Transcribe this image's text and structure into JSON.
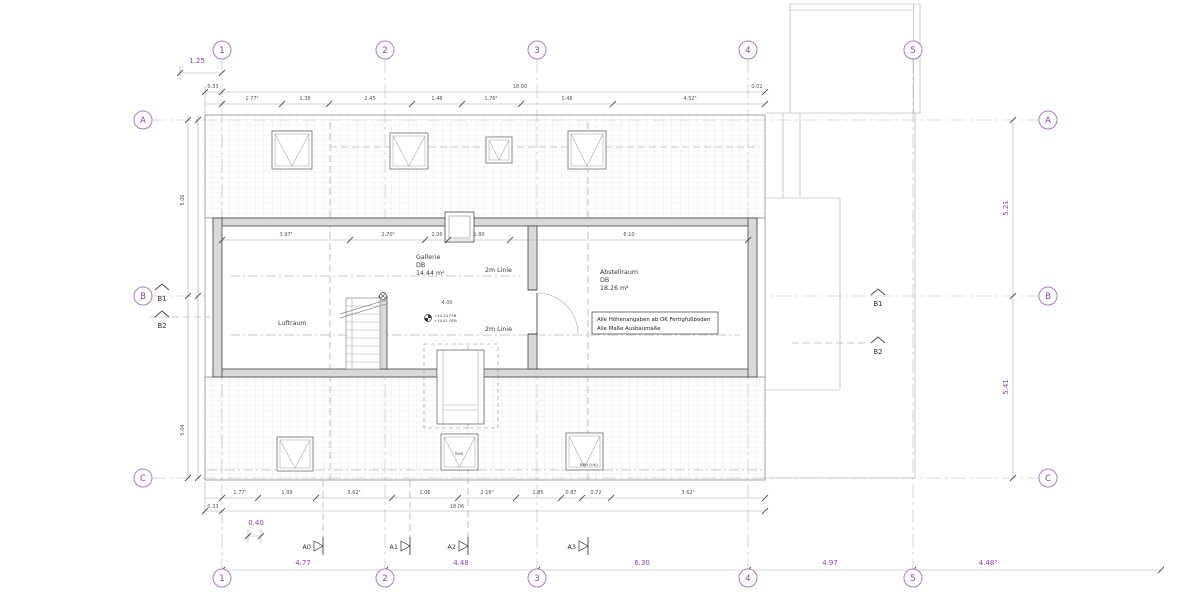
{
  "grid": {
    "top": [
      "1",
      "2",
      "3",
      "4",
      "5"
    ],
    "bottom": [
      "1",
      "2",
      "3",
      "4",
      "5"
    ],
    "left": [
      "A",
      "B",
      "C"
    ],
    "right": [
      "A",
      "B",
      "C"
    ]
  },
  "sections": {
    "left": [
      "B1",
      "B2"
    ],
    "right": [
      "B1",
      "B2"
    ],
    "bottom": [
      "A0",
      "A1",
      "A2",
      "A3"
    ]
  },
  "rooms": {
    "gallerie": {
      "name": "Gallerie",
      "sub": "DB",
      "area": "14.44 m²"
    },
    "abstellraum": {
      "name": "Abstellraum",
      "sub": "DB",
      "area": "18.26 m²"
    },
    "luftraum": {
      "name": "Luftraum"
    },
    "linie2m_upper": {
      "name": "2m Linie"
    },
    "linie2m_lower": {
      "name": "2m Linie"
    }
  },
  "note": {
    "line1": "Alle Höhenangaben ab OK Fertigfußboden",
    "line2": "Alle Maße Ausbaumaße"
  },
  "levels": {
    "ffb": "+10.54 FFB",
    "rfb": "+10.41 RFB"
  },
  "labels": {
    "rwa": "RWA",
    "brh": "BRH 0.90"
  },
  "dims": {
    "purple": {
      "top_left": "1.25",
      "bottom_left": "0.40",
      "bottom": [
        "4.77",
        "4.48",
        "6.30",
        "4.97",
        "4.48⁵"
      ],
      "right_upper": "5.21",
      "right_lower": "5.41"
    },
    "top_total": {
      "left": "0.33",
      "value": "18.00",
      "right": "0.02"
    },
    "top_segments": [
      "1.77⁵",
      "1.38",
      "2.45",
      "1.48",
      "1.76⁵",
      "1.48",
      "4.52⁵"
    ],
    "bottom_segments": [
      "1.77⁵",
      "1.99",
      "3.62⁵",
      "1.06",
      "2.16⁵",
      "1.85",
      "0.87",
      "0.72",
      "3.62⁵"
    ],
    "bottom_total": {
      "left": "0.33",
      "value": "18.06"
    },
    "interior": [
      "3.97⁵",
      "2.70⁵",
      "1.06",
      "1.80",
      "6.10"
    ],
    "interior_mid": "4.00",
    "left_vertical": [
      "5.06",
      "5.04"
    ]
  }
}
